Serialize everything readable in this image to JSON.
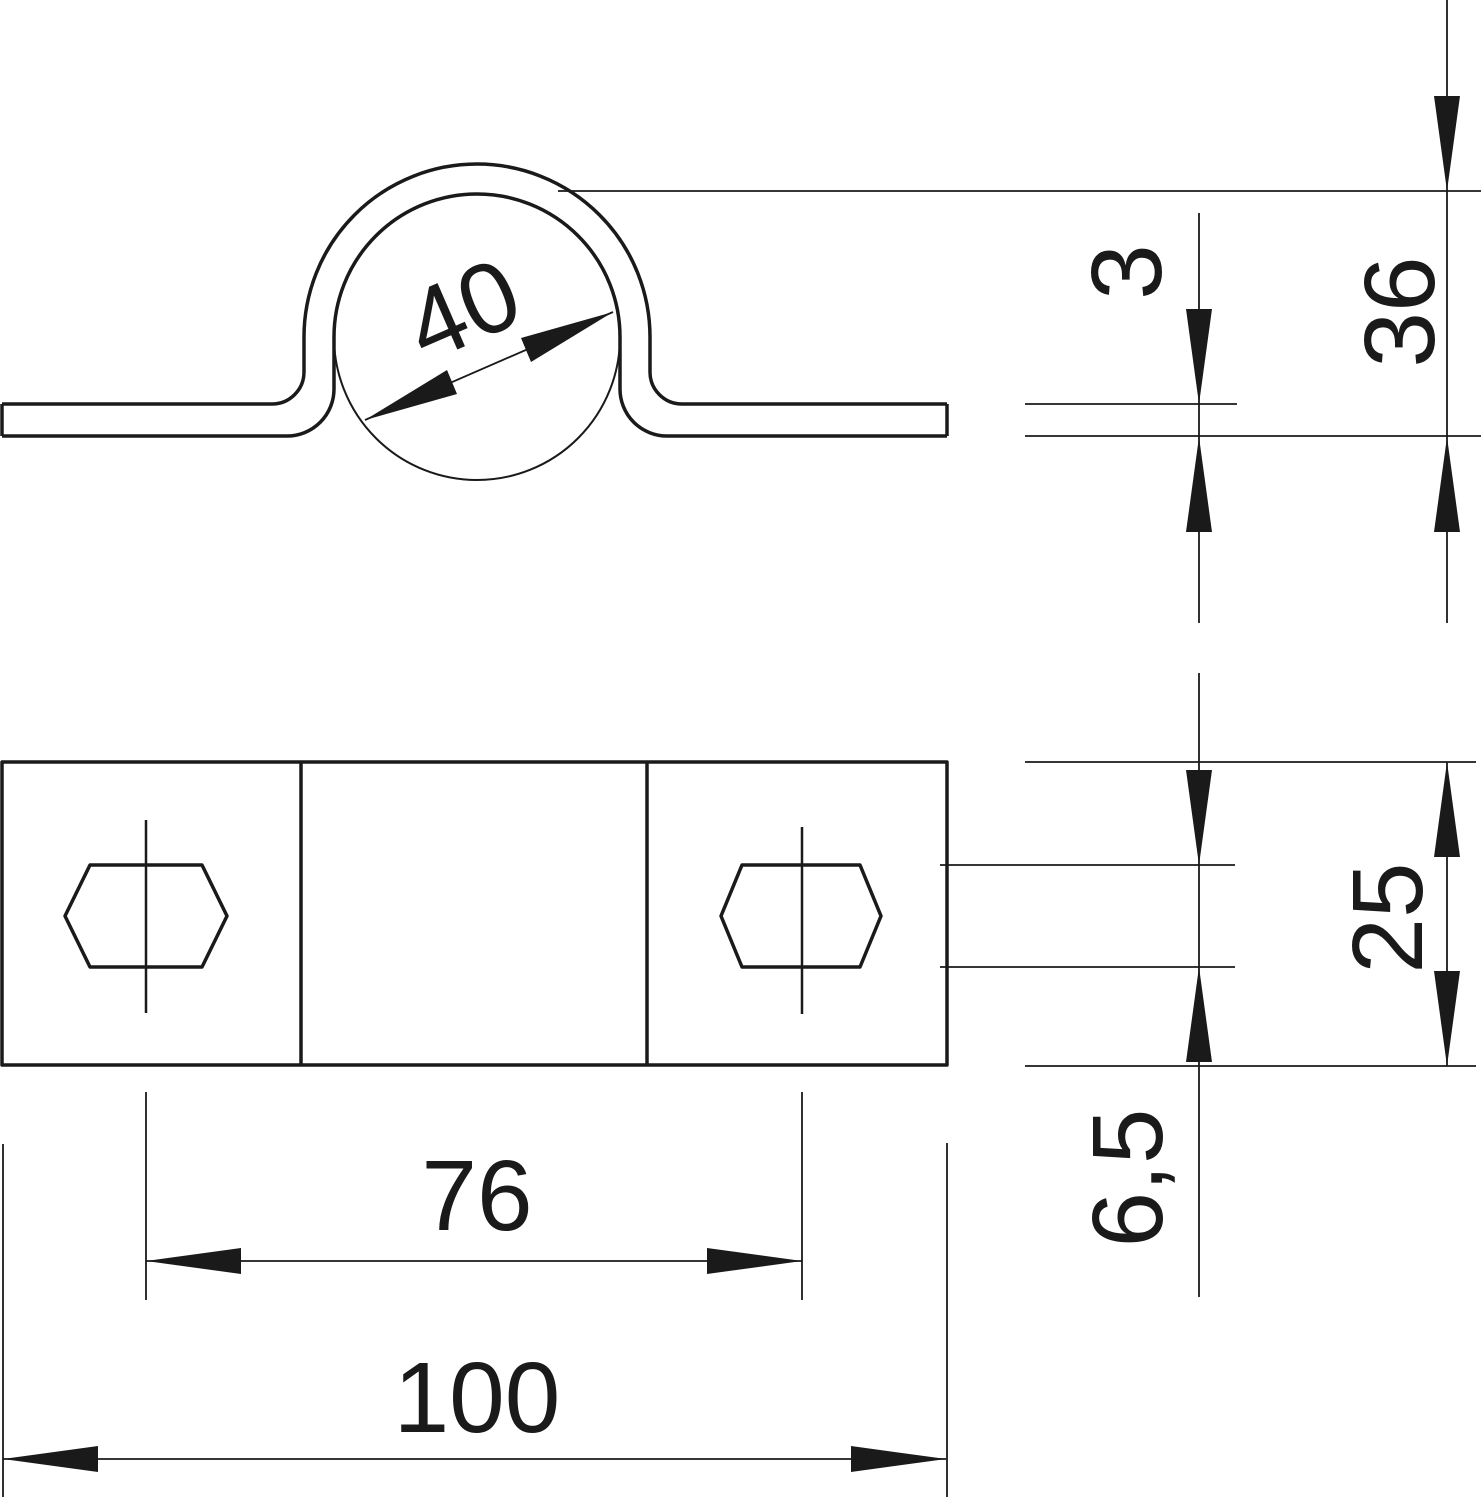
{
  "drawing": {
    "background_color": "#ffffff",
    "line_color": "#1a1a1a",
    "dimensions": {
      "pipe_diameter": "40",
      "material_thickness": "3",
      "overall_height": "36",
      "plate_width": "25",
      "hole_width": "6,5",
      "hole_spacing": "76",
      "overall_length": "100"
    }
  }
}
